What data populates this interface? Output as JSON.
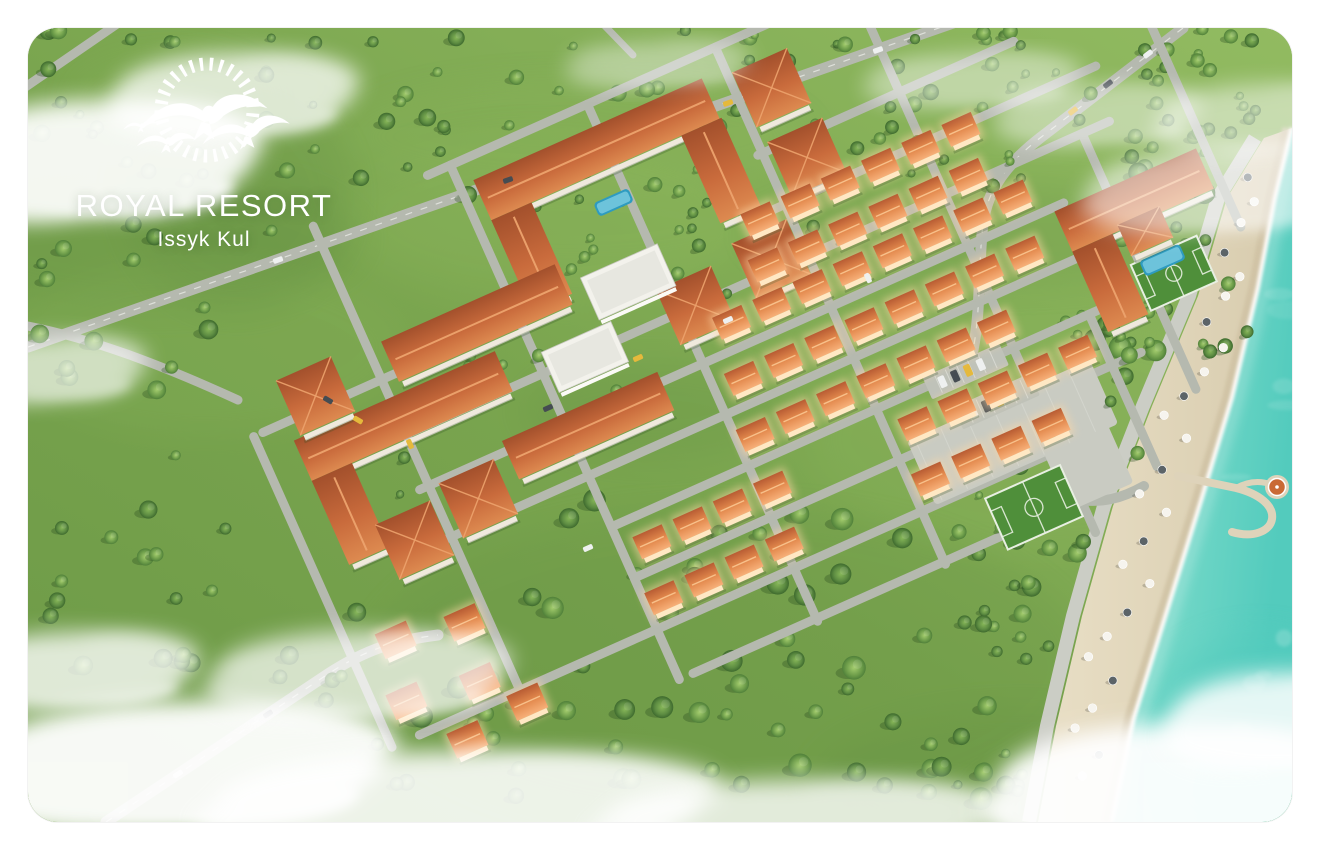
{
  "logo": {
    "title": "ROYAL RESORT",
    "subtitle": "Issyk Kul",
    "mark": "sun-and-seagulls-icon"
  },
  "scene": {
    "type": "aerial-3d-render",
    "subject": "lakeside resort masterplan with beach on turquoise lake",
    "landmarks": [
      "apartment-blocks-district",
      "townhouse-rows",
      "villa-cluster",
      "hotel-with-pool",
      "football-pitch-upper",
      "football-pitch-lower",
      "central-plaza",
      "street-grid",
      "access-roads",
      "beach-promenade",
      "sandy-beach",
      "beach-umbrellas",
      "pier-with-gazebo",
      "turquoise-lake",
      "scattered-trees",
      "low-clouds"
    ]
  },
  "colors": {
    "pageBg": "#ffffff",
    "grass": "#79a44e",
    "grassLight": "#92bb61",
    "grassDark": "#5a863d",
    "tree1a": "#a3cc6d",
    "tree1b": "#50803a",
    "tree2a": "#86b658",
    "tree2b": "#3e6a2e",
    "treeShadow": "#274a1e",
    "road": "#b5b9af",
    "roadDash": "#eceee8",
    "paved": "#c9cbc2",
    "aptRoofTop": "#a3502c",
    "aptRoofLow": "#dd8a50",
    "roofRidge": "#eda36d",
    "townRoofTop": "#b85c33",
    "townRoofLow": "#f7b079",
    "glow": "#ffd9a6",
    "facadeGlow": "#ffe8c4",
    "facade": "#efe9dd",
    "whiteWall": "#f3f2ec",
    "whiteRoof": "#e7e7e0",
    "pool": "#2e9bc0",
    "poolLight": "#8fd8ea",
    "pitch": "#4f8f3a",
    "pitchLine": "#e8efe2",
    "sand": "#e9dfc6",
    "sandLow": "#d7cbad",
    "sandWet": "#cdbfa0",
    "promenade": "#cbcdc5",
    "water": "#7edccb",
    "waterDeep": "#53cbbd",
    "waterShallow": "#b2e8d6",
    "foam": "#ffffff",
    "cloud": "#ffffff",
    "carYellow": "#e5b93c",
    "carWhite": "#eef0f0",
    "carDark": "#454c52",
    "pierDeck": "#ded3ba",
    "gazeboRoof": "#c96a35",
    "logoText": "#ffffff"
  }
}
